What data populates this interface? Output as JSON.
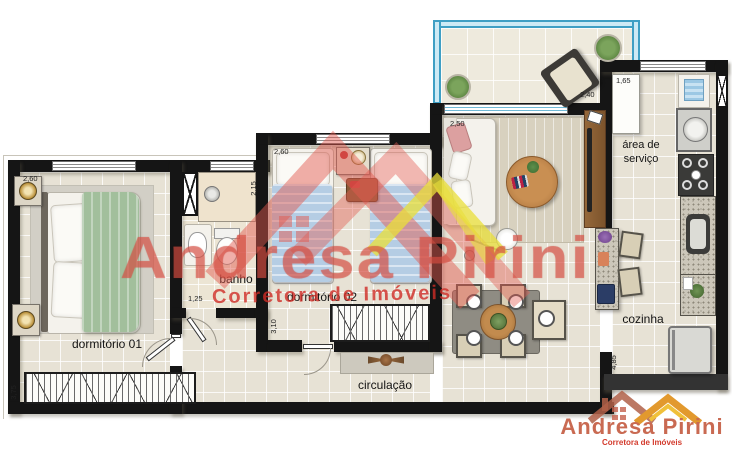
{
  "plan": {
    "rooms": [
      {
        "label": "dormitório 01"
      },
      {
        "label": "banho"
      },
      {
        "label": "dormitório 02"
      },
      {
        "label": "circulação"
      },
      {
        "label": "cozinha"
      },
      {
        "label": "área de serviço"
      }
    ],
    "dimensions": {
      "dorm1_width": "2,60",
      "dorm1_depth": "3,75",
      "banho_width": "1,25",
      "banho_depth": "2,15",
      "dorm2_width": "2,60",
      "dorm2_depth": "3,10",
      "sala_width": "2,50",
      "varanda_width": "2,40",
      "servico_width": "1,65",
      "cozinha_depth": "4,85"
    }
  },
  "watermark": {
    "name": "Andresa Pirini",
    "tagline": "Corretora de Imóveis"
  },
  "logo": {
    "name": "Andresa Pirini",
    "tagline": "Corretora de Imóveis"
  },
  "colors": {
    "wall": "#151515",
    "watermark_red": "#e0564a",
    "watermark_yellow": "#eadf3a",
    "railing_blue": "#3f9fc4",
    "logo_red": "#c96a52"
  }
}
